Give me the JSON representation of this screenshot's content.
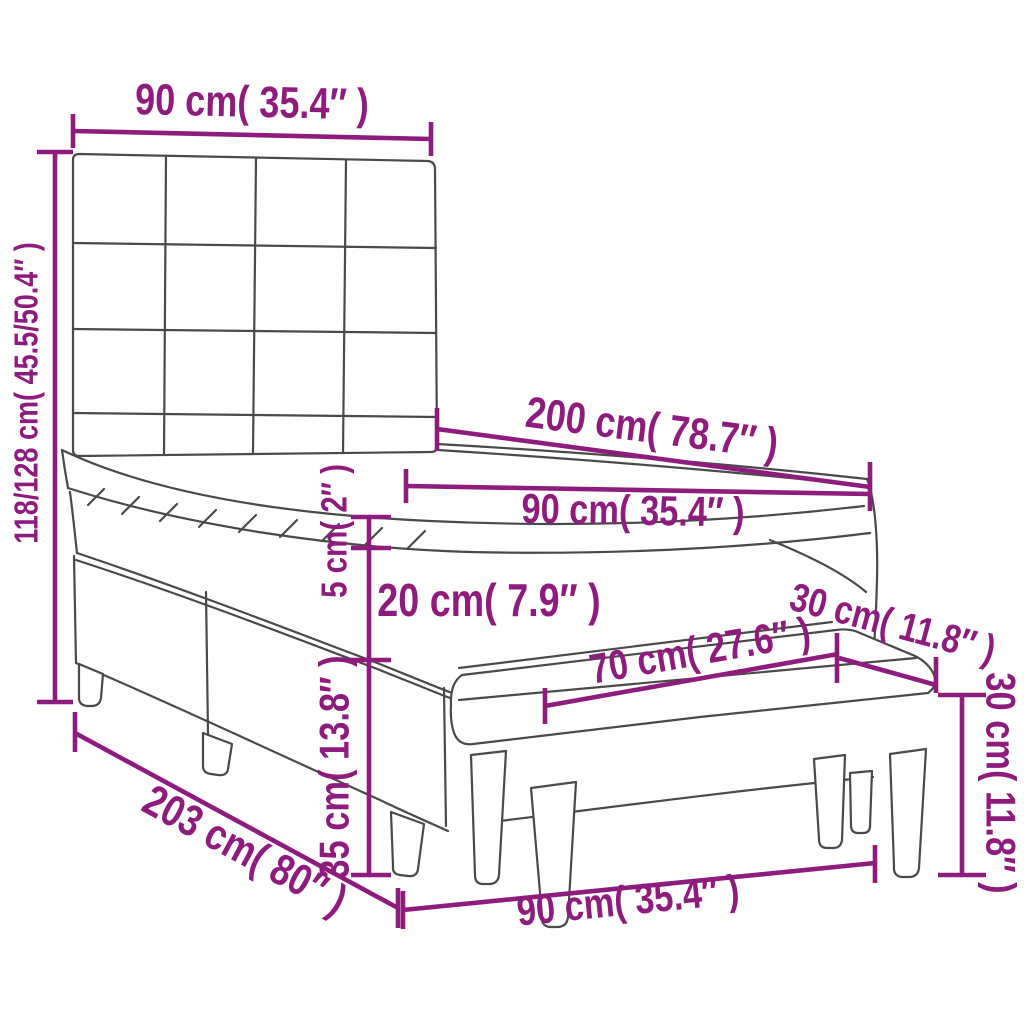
{
  "diagram": {
    "type": "product-dimension-diagram",
    "subject": "box spring bed with tufted headboard, mattress, topper and bench",
    "colors": {
      "dimension": "#8E1C7D",
      "outline": "#4A4A4A",
      "background": "#FFFFFF"
    },
    "labels": {
      "headboard_width": "90 cm( 35.4″ )",
      "overall_height": "118/128 cm( 45.5/50.4″ )",
      "bed_length": "200 cm( 78.7″ )",
      "mattress_width": "90 cm( 35.4″ )",
      "topper_height": "5 cm( 2″ )",
      "mattress_height": "20 cm( 7.9″ )",
      "base_height": "35 cm( 13.8″ )",
      "overall_length": "203 cm( 80″ )",
      "bench_length": "70 cm( 27.6″ )",
      "bench_depth": "30 cm( 11.8″ )",
      "bench_height": "30 cm( 11.8″ )",
      "footprint_width": "90 cm( 35.4″ )"
    }
  }
}
